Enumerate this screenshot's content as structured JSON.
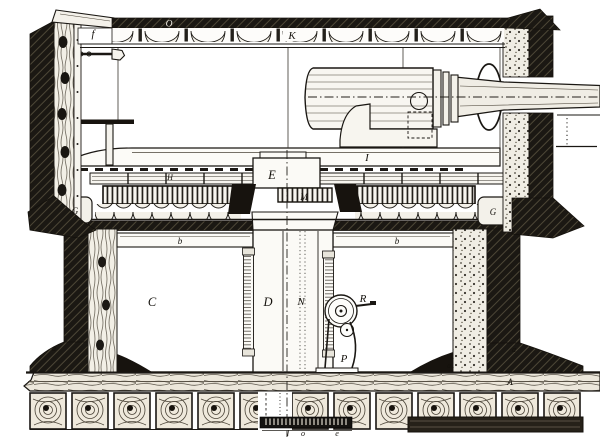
{
  "colors": {
    "paper": "#ffffff",
    "ink": "#1a1713"
  },
  "labels": {
    "roof_plate_f": "f",
    "roof_bar_o": "O",
    "roof_beam_k": "K",
    "spindle_head_e": "E",
    "rail_h": "H",
    "gun_slide_i": "I",
    "spindle_gear_m": "M",
    "ring_cap_left_g": "G",
    "ring_cap_right_g": "G",
    "brace_left_b": "b",
    "brace_right_b": "b",
    "chamber_c": "C",
    "spindle_column_d": "D",
    "axis_n": "N",
    "handwheel_r": "R",
    "wheel_frame_p": "P",
    "deck_plank_a_cap": "A",
    "foot_left_a": "a",
    "foot_mid_a": "a",
    "foot_right_a": "a",
    "base_l": "l",
    "base_o": "o",
    "base_e": "e"
  }
}
